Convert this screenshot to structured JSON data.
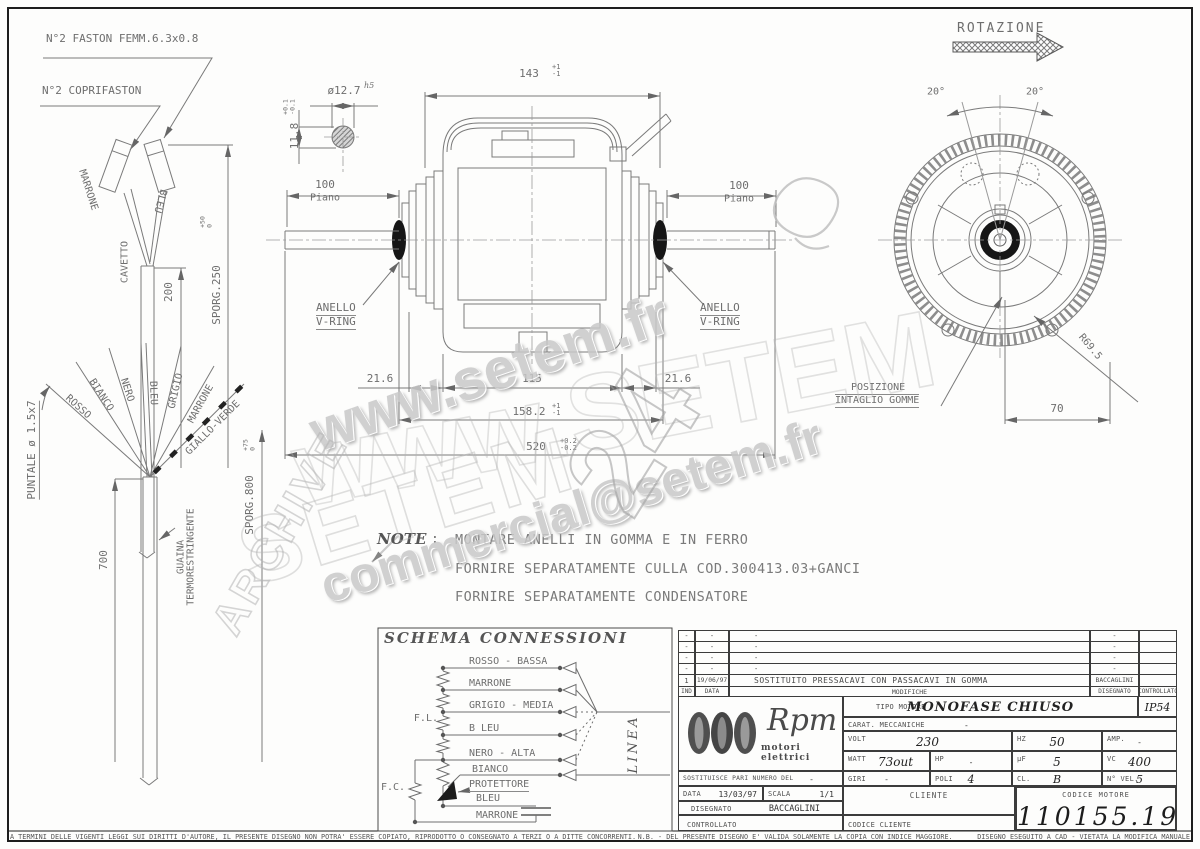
{
  "frame": {
    "legal_left": "A TERMINI DELLE VIGENTI LEGGI SUI DIRITTI D'AUTORE, IL PRESENTE DISEGNO NON POTRA' ESSERE COPIATO, RIPRODOTTO O CONSEGNATO A TERZI O A DITTE CONCORRENTI.",
    "legal_right": "N.B. - DEL PRESENTE DISEGNO E' VALIDA SOLAMENTE LA COPIA CON INDICE MAGGIORE.      DISEGNO ESEGUITO A CAD - VIETATA LA MODIFICA MANUALE"
  },
  "watermarks": {
    "url": "www.setem.fr",
    "url_big": "www.SETEM",
    "brand": "SETEM",
    "email": "commercial@setem.fr",
    "archive": "ARCHIVE",
    "pencil_number": "24"
  },
  "top_cable": {
    "faston": "N°2 FASTON FEMM.6.3x0.8",
    "coprifaston": "N°2 COPRIFASTON",
    "wire_marrone": "MARRONE",
    "wire_bleu": "BLEU",
    "cavetto": "CAVETTO",
    "dim_len": "200",
    "sporg": "SPORG.250",
    "sporg_tol_plus": "+50",
    "sporg_tol_zero": "0"
  },
  "wire_fan": {
    "puntale": "PUNTALE ø 1.5x7",
    "w_rosso": "ROSSO",
    "w_bianco": "BIANCO",
    "w_nero": "NERO",
    "w_bleu": "BLEU",
    "w_grigio": "GRIGIO",
    "w_marrone": "MARRONE",
    "w_gialloverde": "GIALLO-VERDE",
    "dim_len": "700",
    "guaina1": "GUAINA",
    "guaina2": "TERMORESTRINGENTE",
    "sporg": "SPORG.800",
    "sporg_tol_plus": "+75",
    "sporg_tol_zero": "0"
  },
  "motor": {
    "dim_total": "143",
    "dim_total_tp": "+1",
    "dim_total_tm": "-1",
    "shaft_dia": "ø12.7",
    "shaft_fit": "h5",
    "dim_key": "11.8",
    "dim_key_tp": "+0.1",
    "dim_key_tm": "-0.1",
    "dim_plane": "100",
    "plane": "Piano",
    "vring1": "ANELLO",
    "vring2": "V-RING",
    "dim_hub": "21.6",
    "dim_mid": "115",
    "dim_stack": "158.2",
    "dim_stack_tp": "+1",
    "dim_stack_tm": "-1",
    "dim_shaft_total": "520",
    "dim_shaft_tp": "+0.2",
    "dim_shaft_tm": "-0.2"
  },
  "end_view": {
    "rotazione": "ROTAZIONE",
    "angle_l": "20°",
    "angle_r": "20°",
    "radius": "R69.5",
    "dim_offset": "70",
    "pos1": "POSIZIONE",
    "pos2": "INTAGLIO GOMME"
  },
  "note": {
    "title": "NOTE",
    "colon": ":",
    "line1": "MONTARE ANELLI IN GOMMA E IN FERRO",
    "line2": "FORNIRE SEPARATAMENTE CULLA COD.300413.03+GANCI",
    "line3": "FORNIRE SEPARATAMENTE CONDENSATORE"
  },
  "schema": {
    "title": "SCHEMA CONNESSIONI",
    "fl": "F.L.",
    "fc": "F.C.",
    "linea": "LINEA",
    "w1": "ROSSO - BASSA",
    "w2": "MARRONE",
    "w3": "GRIGIO - MEDIA",
    "w4": "B LEU",
    "w5": "NERO - ALTA",
    "w6": "BIANCO",
    "w7": "PROTETTORE",
    "w8": "BLEU",
    "w9": "MARRONE"
  },
  "titleblock": {
    "rev_rows": [
      {
        "ind": "-",
        "date": "-",
        "mod": "-",
        "drawn": "-"
      },
      {
        "ind": "-",
        "date": "-",
        "mod": "-",
        "drawn": "-"
      },
      {
        "ind": "-",
        "date": "-",
        "mod": "-",
        "drawn": "-"
      },
      {
        "ind": "-",
        "date": "-",
        "mod": "-",
        "drawn": "-"
      },
      {
        "ind": "1",
        "date": "19/06/97",
        "mod": "SOSTITUITO PRESSACAVI CON PASSACAVI IN GOMMA",
        "drawn": "BACCAGLINI"
      }
    ],
    "rev_h_ind": "IND",
    "rev_h_date": "DATA",
    "rev_h_mod": "MODIFICHE",
    "rev_h_drawn": "DISEGNATO",
    "rev_h_check": "CONTROLLATO",
    "logo_name": "Rpm",
    "logo_sub": "motori elettrici",
    "tipo_label": "TIPO MOTORE",
    "tipo_value": "MONOFASE CHIUSO",
    "ip": "IP54",
    "carat_label": "CARAT. MECCANICHE",
    "carat_value": "-",
    "volt_label": "VOLT",
    "volt": "230",
    "hz_label": "HZ",
    "hz": "50",
    "amp_label": "AMP.",
    "amp": "-",
    "watt_label": "WATT",
    "watt": "73out",
    "hp_label": "HP",
    "hp": "-",
    "uf_label": "µF",
    "uf": "5",
    "vc_label": "VC",
    "vc": "400",
    "giri_label": "GIRI",
    "giri": "-",
    "poli_label": "POLI",
    "poli": "4",
    "cl_label": "CL.",
    "cl": "B",
    "nvel_label": "N° VEL.",
    "nvel": "5",
    "sost_label": "SOSTITUISCE PARI NUMERO DEL",
    "sost_value": "-",
    "data_label": "DATA",
    "data_value": "13/03/97",
    "scala_label": "SCALA",
    "scala_value": "1/1",
    "cliente_label": "CLIENTE",
    "codice_motore_label": "CODICE MOTORE",
    "codice_motore": "110155.19",
    "disegnato_label": "DISEGNATO",
    "disegnato_value": "BACCAGLINI",
    "controllato_label": "CONTROLLATO",
    "codice_cliente_label": "CODICE CLIENTE"
  }
}
